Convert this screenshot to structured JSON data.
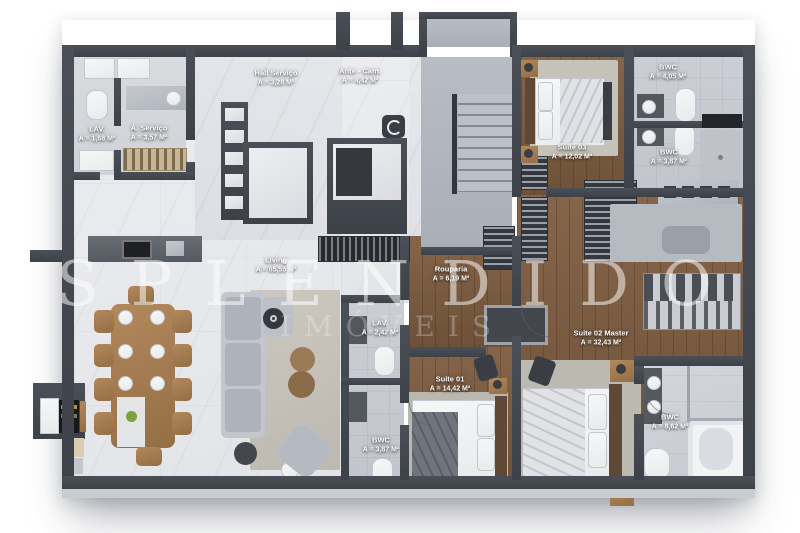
{
  "watermark": {
    "title": "SPLENDIDO",
    "subtitle": "IMÓVEIS"
  },
  "rooms": {
    "hall_servico": {
      "name": "Hall Serviço",
      "area": "A = 3,28 M²"
    },
    "ante_cam": {
      "name": "Ante - Cam.",
      "area": "A = 4,42 M²"
    },
    "bwc_ante": {
      "name": "BWC",
      "area": "A = 4,05 M²"
    },
    "lav_servico": {
      "name": "LAV.",
      "area": "A = 1,68 M²"
    },
    "area_servico": {
      "name": "Á. Serviço",
      "area": "A = 3,57 M²"
    },
    "suite03": {
      "name": "Suite 03",
      "area": "A = 12,02 M²"
    },
    "bwc_suite03": {
      "name": "BWC",
      "area": "A = 3,87 M²"
    },
    "living": {
      "name": "Living",
      "area": "A = 65,55  M²"
    },
    "rouparia": {
      "name": "Rouparia",
      "area": "A = 6,19 M²"
    },
    "lav_social": {
      "name": "LAV.",
      "area": "A = 2,42 M²"
    },
    "suite02": {
      "name": "Suite 02 Master",
      "area": "A = 32,43 M²"
    },
    "suite01": {
      "name": "Suite 01",
      "area": "A = 14,42 M²"
    },
    "bwc_suite01": {
      "name": "BWC",
      "area": "A = 3,87 M²"
    },
    "bwc_master": {
      "name": "BWC",
      "area": "A = 8,62 M²"
    }
  },
  "palette": {
    "wall": "#43474f",
    "marble_floor": "#e8e9ec",
    "wood_floor": "#7b5d43",
    "bath_tile": "#c7cad1",
    "label_text": "#ffffff",
    "watermark_white": "#ffffff"
  }
}
